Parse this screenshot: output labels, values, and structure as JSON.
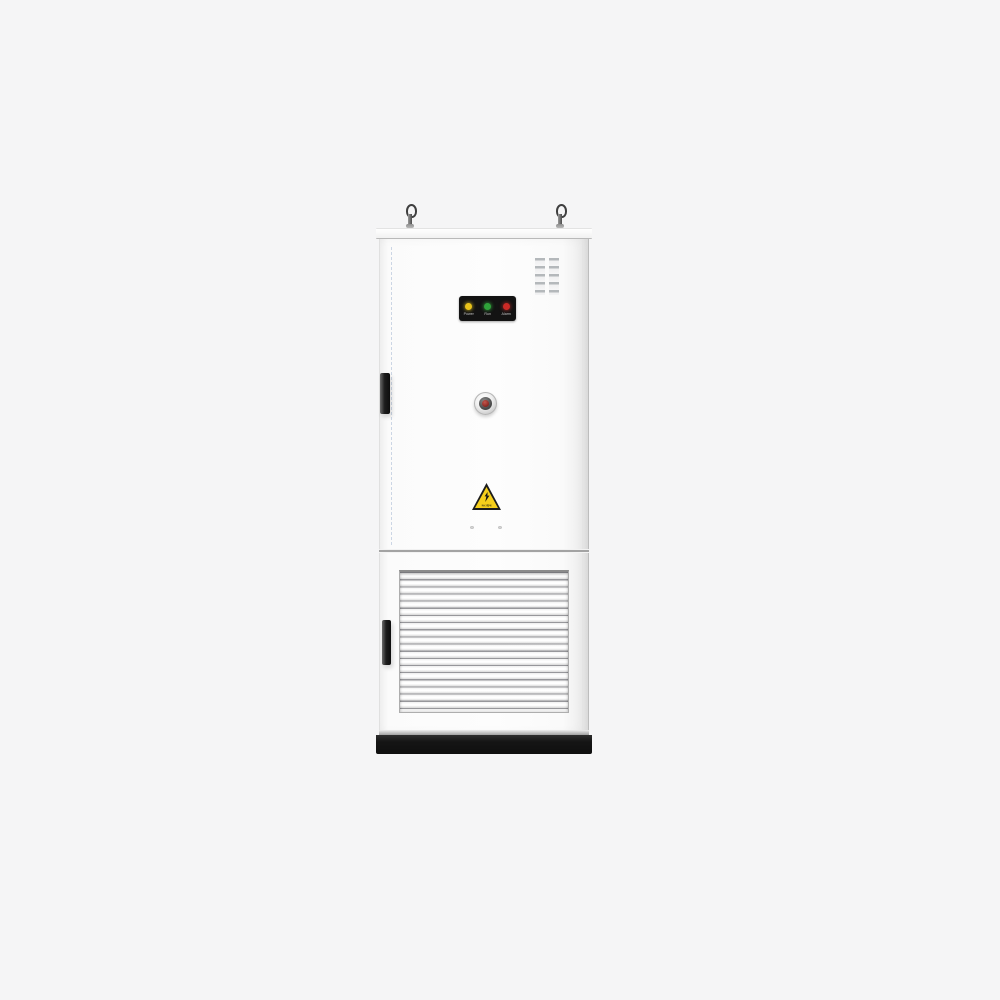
{
  "scene": {
    "type": "product-photo",
    "subject": "white industrial power cabinet (vertical electrical enclosure)",
    "background_color": "#f5f5f6"
  },
  "cabinet": {
    "body_color": "#fcfcfc",
    "top_cap_color": "#f7f7f7",
    "plinth_color": "#151515",
    "lifting_eyes": {
      "count": 2,
      "color": "#3f3f3f"
    },
    "vent_grid": {
      "columns": 2,
      "rows": 5,
      "slot_color": "#b4b8bb"
    },
    "indicator_panel": {
      "background": "#131313",
      "leds": [
        {
          "name": "power-led",
          "color": "#e8c21a",
          "label": "Power"
        },
        {
          "name": "run-led",
          "color": "#2fa33a",
          "label": "Run"
        },
        {
          "name": "alarm-led",
          "color": "#cc2a26",
          "label": "Alarm"
        }
      ]
    },
    "round_button": {
      "outer_ring": "#e9e9e9",
      "mid_ring": "#4a4a4a",
      "center": "#8a2722"
    },
    "warning_sticker": {
      "triangle_color": "#f6cf1b",
      "border_color": "#1c1c1c",
      "symbol": "high-voltage-bolt",
      "caption": "当心触电"
    },
    "door_handles": {
      "count": 2,
      "color": "#1d1d1d"
    },
    "louver_grille": {
      "slats": 20,
      "frame_color": "#aeaeae"
    }
  }
}
